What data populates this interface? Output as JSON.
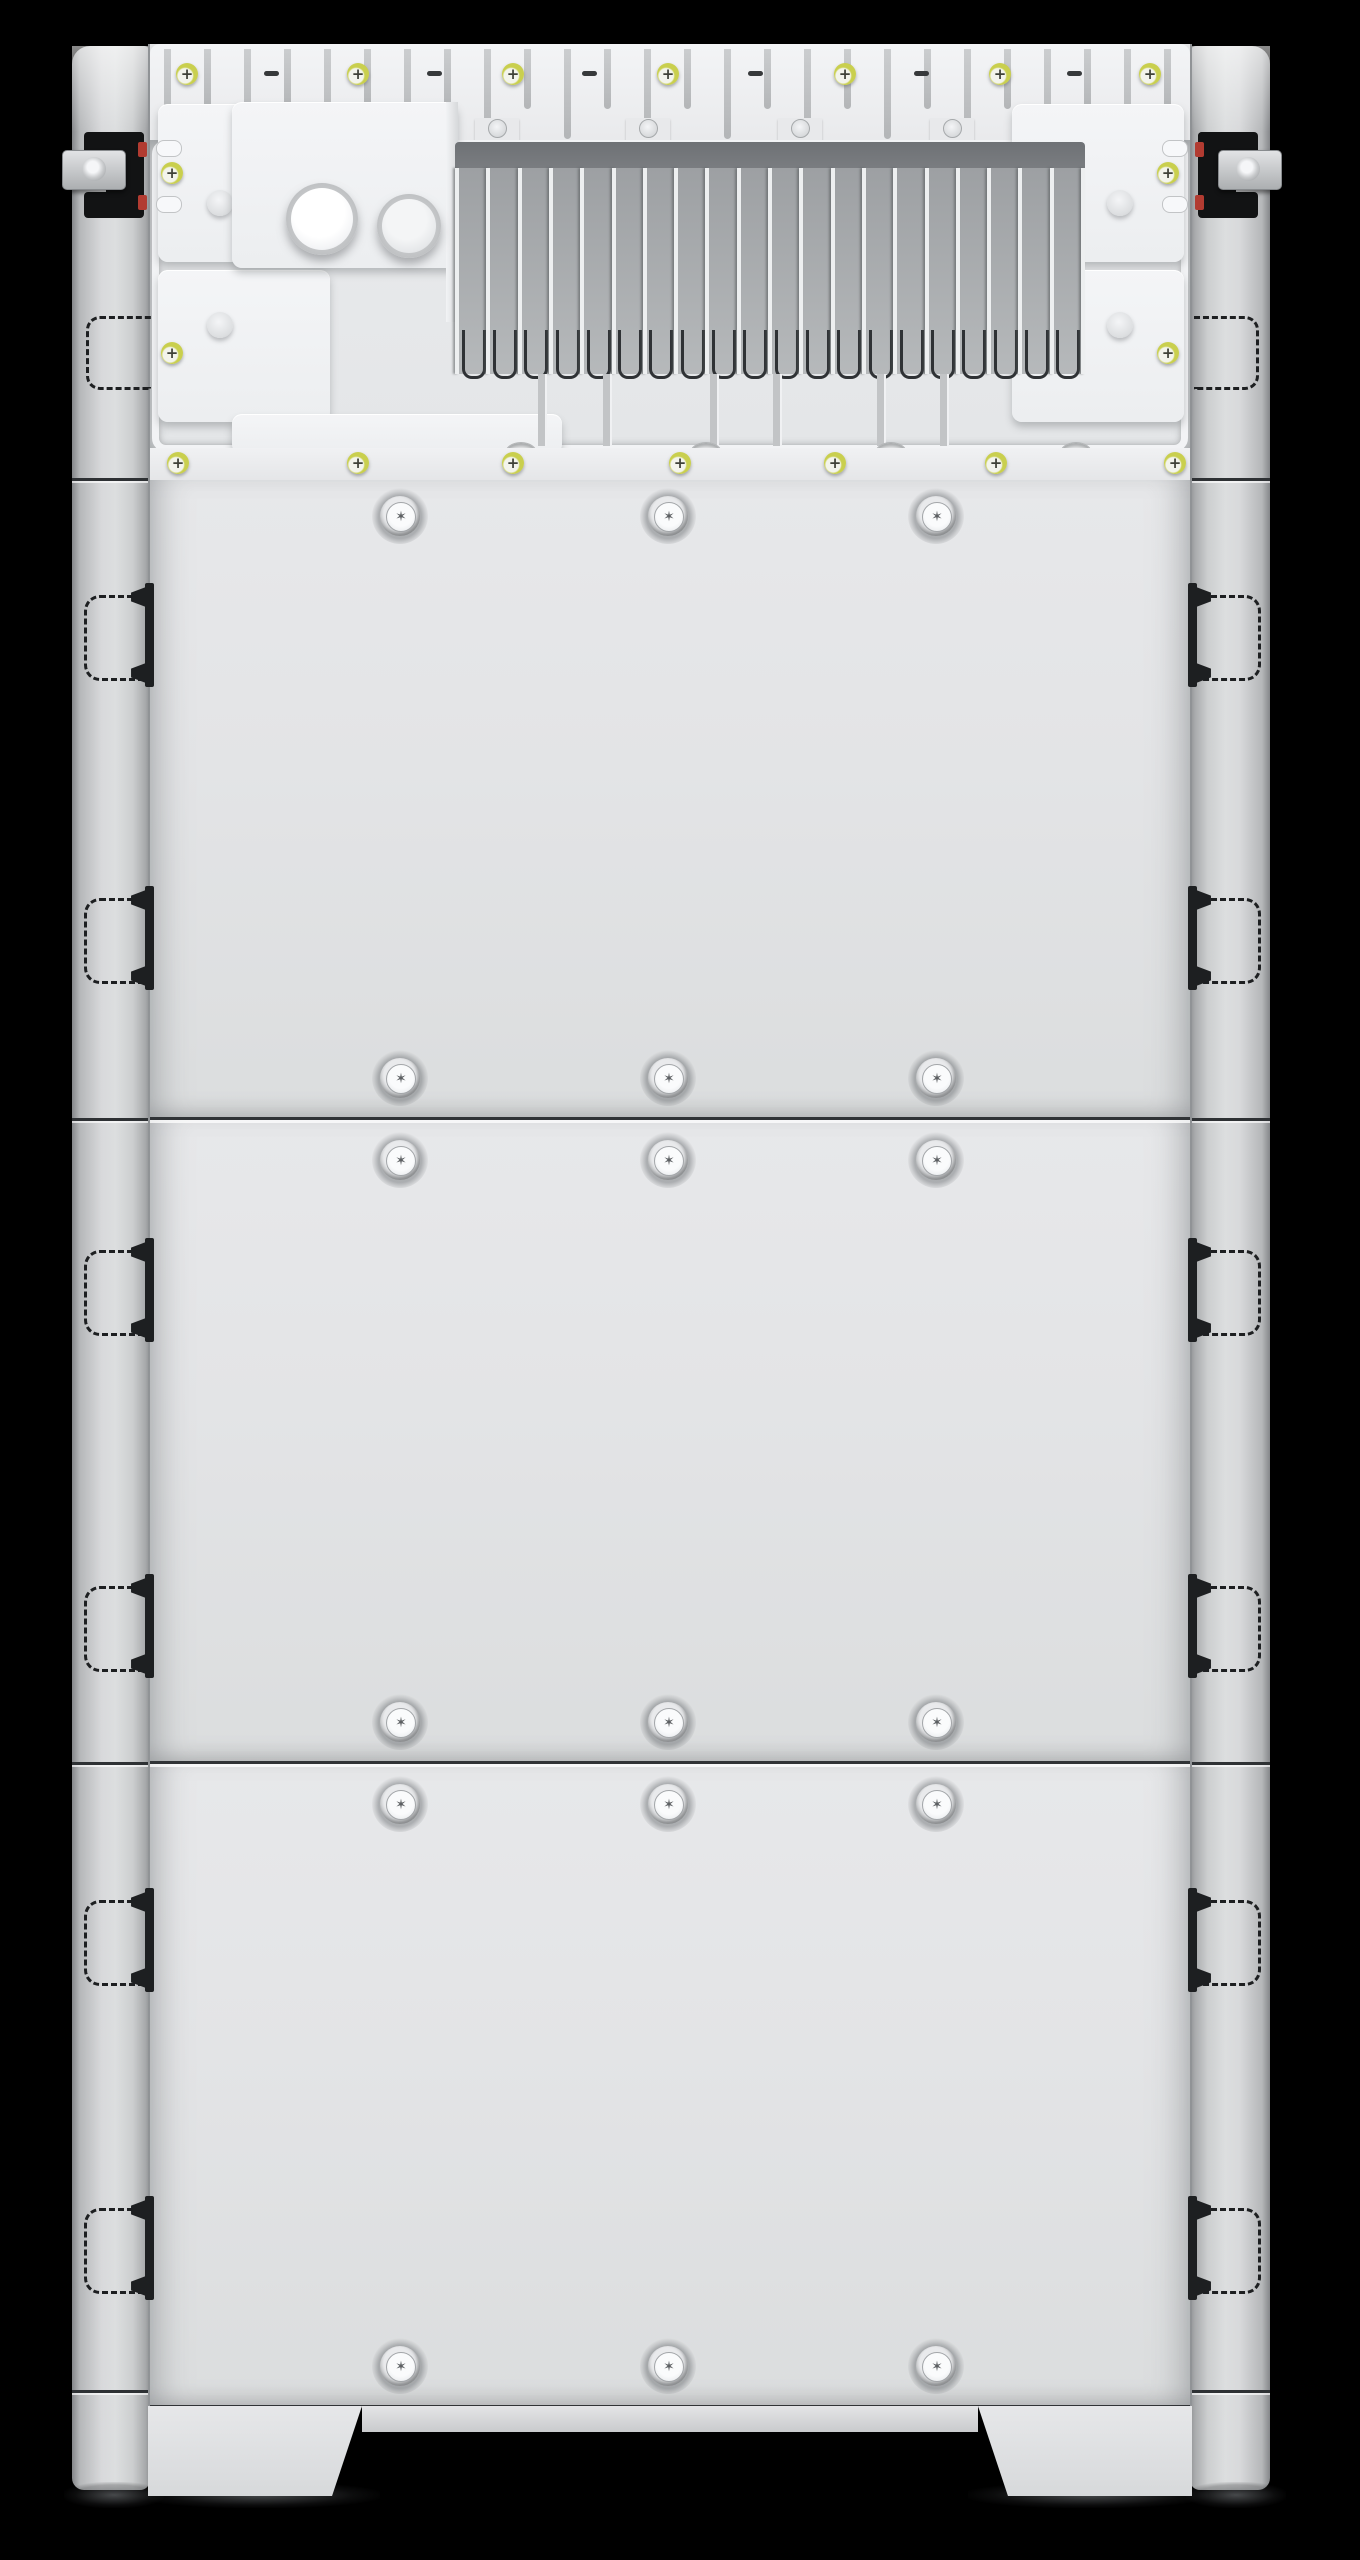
{
  "meta": {
    "title": "Stacked battery energy storage cabinet - front view render",
    "description": "Photorealistic render of a floor-standing energy storage stack: exposed top wiring bay with finned heat sink and cable-gland knockouts, three stacked battery modules fastened with Torx screws, side mounting rails with recessed handle cutouts, clamp latches at the top, and two front feet on a black background.",
    "background_color": "#000000"
  },
  "glyphs": {
    "plus_screw": "+",
    "torx_screw": "✶"
  },
  "colors": {
    "background": "#000000",
    "panel": "#e3e4e6",
    "rail_mid": "#cfd1d3",
    "seam_dark": "#303336",
    "heatsink_band": "#6e7175",
    "heatsink_body": "#a8abae",
    "fin_light": "#edeff0",
    "channel_dark": "#2f3235",
    "washer_yellow": "#c9cf4e",
    "screw_face": "#f2f3ea",
    "screw_mark": "#3f4138",
    "torx_face": "#f4f5f6",
    "torx_star": "#5d6063",
    "latch_black": "#121314",
    "latch_red": "#b23b31",
    "handle_mark": "#1d1f21"
  },
  "layout": {
    "canvas": {
      "width": 1360,
      "height": 2560
    },
    "unit": {
      "left": 72,
      "right": 1270,
      "top": 44
    },
    "body": {
      "left": 150,
      "right": 1190,
      "top": 44,
      "bottom": 2406
    },
    "rails": {
      "left_x": 72,
      "left_w": 78,
      "right_x": 1190,
      "right_w": 80,
      "top": 46,
      "bottom": 2490
    }
  },
  "top_section": {
    "comb": {
      "y": 44,
      "height": 96,
      "slot_count": 26,
      "plus_screw_x": [
        187,
        358,
        513,
        668,
        845,
        1000,
        1150
      ],
      "screw_y": 74,
      "minus_slot_x": [
        272,
        435,
        590,
        756,
        922,
        1075
      ],
      "pin_x": [
        497,
        648,
        800,
        952,
        1104
      ],
      "pin_y": 128
    },
    "interior": {
      "y": 140,
      "height": 308
    },
    "bays": {
      "left_x": 158,
      "right_x": 1012,
      "width": 172,
      "box_rows": [
        {
          "y": 104,
          "h": 158
        },
        {
          "y": 270,
          "h": 152
        }
      ],
      "screw_x_left": 172,
      "screw_x_right": 1168,
      "screw_y": [
        173,
        353
      ],
      "knob_x_left": 220,
      "knob_x_right": 1120,
      "knob_y": [
        203,
        325
      ],
      "pill_y": [
        140,
        196
      ]
    },
    "center_box": {
      "x": 232,
      "y": 102,
      "w": 226,
      "h": 166
    },
    "center_wall": {
      "x": 446,
      "y": 102,
      "w": 12,
      "h": 220
    },
    "lower_box": {
      "x": 232,
      "y": 414,
      "w": 330,
      "h": 40
    },
    "cylinders": [
      {
        "cx": 322,
        "cy": 219,
        "d": 62,
        "bright": true
      },
      {
        "cx": 409,
        "cy": 226,
        "d": 54,
        "bright": false
      }
    ],
    "heatsink": {
      "x": 455,
      "w": 630,
      "band_y": 142,
      "band_h": 64,
      "fin_top": 168,
      "fin_bottom": 374,
      "fin_count": 21,
      "channel_y": 330,
      "channel_h": 46
    },
    "shelf": {
      "tab_x": [
        538,
        603,
        710,
        773,
        877,
        940
      ],
      "tab_y": 374,
      "tab_h": 72,
      "oval_x": [
        520,
        705,
        890,
        1075
      ],
      "oval_y": 442
    },
    "base_rail": {
      "y": 448,
      "h": 32,
      "screw_x": [
        178,
        358,
        513,
        680,
        835,
        996,
        1175
      ],
      "screw_y": 463
    }
  },
  "modules": [
    {
      "label": "battery-module-1",
      "top": 480,
      "bottom": 1118,
      "screw_rows_y": [
        516,
        1078
      ]
    },
    {
      "label": "battery-module-2",
      "top": 1118,
      "bottom": 1762,
      "screw_rows_y": [
        1160,
        1722
      ]
    },
    {
      "label": "battery-module-3",
      "top": 1762,
      "bottom": 2406,
      "screw_rows_y": [
        1804,
        2366
      ]
    }
  ],
  "torx_column_x": [
    400,
    668,
    936
  ],
  "rails_detail": {
    "handle_center_y": [
      635,
      938,
      1290,
      1626,
      1940,
      2248
    ],
    "handle": {
      "w": 56,
      "h": 80
    },
    "seam_y": [
      478,
      1118,
      1762,
      2390
    ],
    "dashed_label": {
      "y": 316,
      "h": 68,
      "w": 62
    },
    "latch": {
      "left": {
        "blackA": [
          84,
          132,
          60,
          22
        ],
        "blackB": [
          106,
          132,
          38,
          84
        ],
        "blackC": [
          84,
          192,
          60,
          26
        ],
        "bracket": [
          62,
          150,
          62,
          38
        ],
        "hole": [
          82,
          157,
          24
        ],
        "red_y": [
          142,
          195
        ],
        "red_x": 138
      },
      "right": {
        "blackA": [
          1198,
          132,
          60,
          22
        ],
        "blackB": [
          1198,
          132,
          38,
          84
        ],
        "blackC": [
          1198,
          192,
          60,
          26
        ],
        "bracket": [
          1218,
          150,
          62,
          38
        ],
        "hole": [
          1236,
          157,
          24
        ],
        "red_y": [
          142,
          195
        ],
        "red_x": 1195
      }
    }
  },
  "feet": {
    "top": 2406,
    "bottom": 2496,
    "left": {
      "x": 148,
      "w": 214
    },
    "right": {
      "x": 978,
      "w": 214
    },
    "apron": {
      "x": 362,
      "w": 616,
      "h": 26
    },
    "shadows": [
      {
        "x": 140,
        "w": 240
      },
      {
        "x": 968,
        "w": 240
      },
      {
        "x": 64,
        "w": 100
      },
      {
        "x": 1186,
        "w": 100
      }
    ]
  }
}
